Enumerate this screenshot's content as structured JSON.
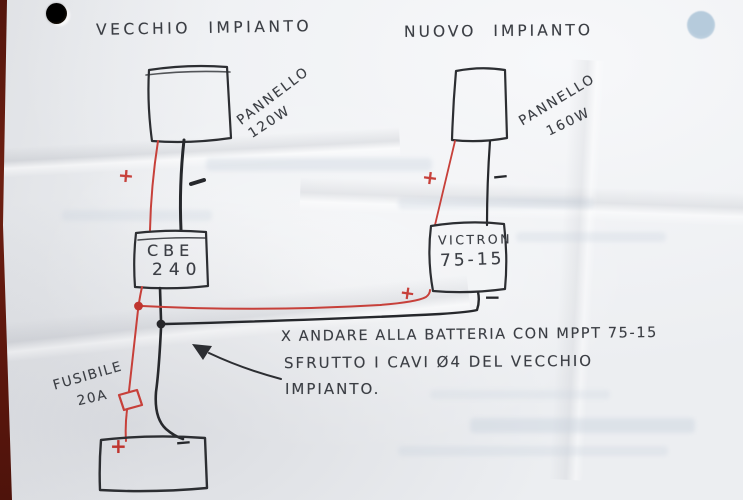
{
  "titles": {
    "old_system": "VECCHIO IMPIANTO",
    "new_system": "NUOVO IMPIANTO"
  },
  "old_system": {
    "panel_label_line1": "PANNELLO",
    "panel_label_line2": "120W",
    "controller_label_line1": "CBE",
    "controller_label_line2": "240",
    "fuse_label_line1": "FUSIBILE",
    "fuse_label_line2": "20A",
    "polarity_plus_top": "+"
  },
  "new_system": {
    "panel_label_line1": "PANNELLO",
    "panel_label_line2": "160W",
    "controller_label_line1": "VICTRON",
    "controller_label_line2": "75-15",
    "polarity_plus_top": "+",
    "polarity_minus_top": "−",
    "polarity_plus_bottom": "+",
    "polarity_minus_bottom": "−"
  },
  "battery": {
    "polarity_plus": "+",
    "polarity_minus": "−"
  },
  "note": {
    "line1": "X ANDARE ALLA BATTERIA CON  MPPT 75-15",
    "line2": "SFRUTTO I CAVI Ø4 DEL VECCHIO",
    "line3": "IMPIANTO."
  },
  "colors": {
    "red_ink": "#c7403a",
    "black_ink": "#2c2e32",
    "paper": "#eceef1",
    "table_edge": "#671c10",
    "hole_dark": "#1f1812",
    "hole_light": "#b6cbdc"
  }
}
